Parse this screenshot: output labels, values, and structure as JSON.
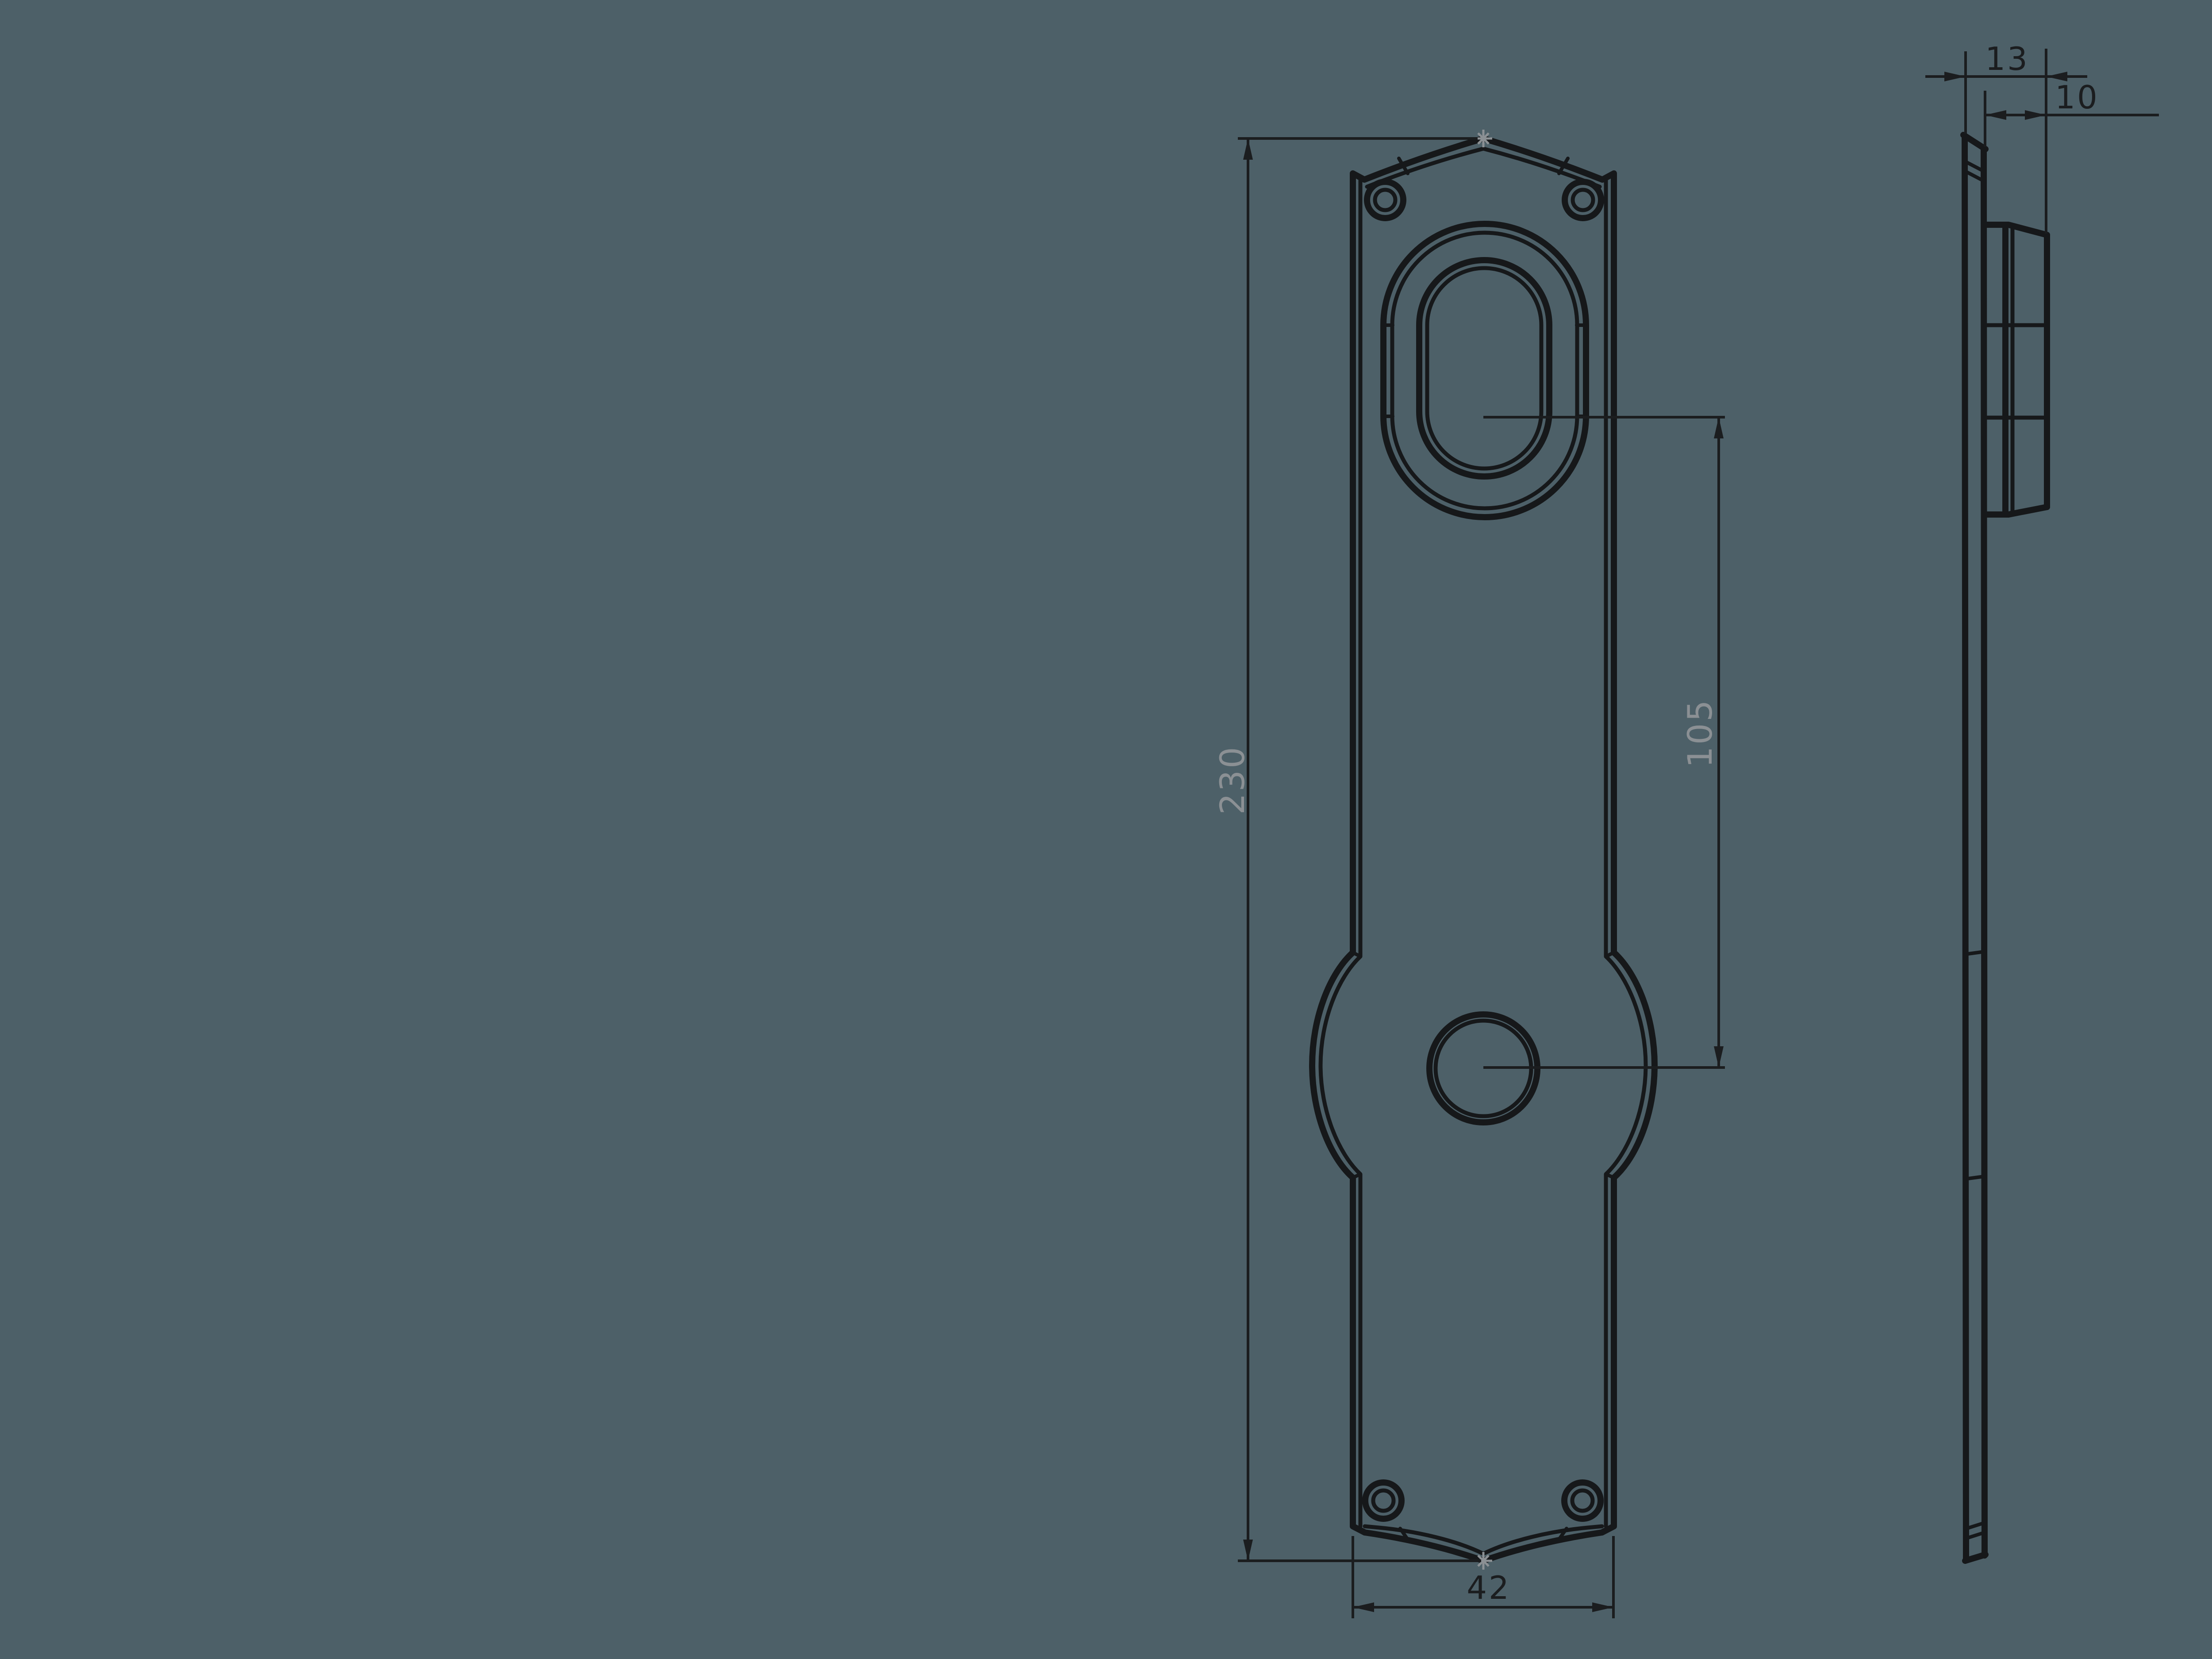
{
  "drawing": {
    "type": "technical-drawing",
    "part": "door-backplate",
    "views": {
      "front_view": {
        "features": [
          "arched-top",
          "oval-keyhole-boss",
          "spindle-hole",
          "four-screw-holes",
          "side-bulge",
          "curved-bottom"
        ]
      },
      "side_view": {
        "features": [
          "thin-plate-profile",
          "raised-boss-profile"
        ]
      }
    },
    "dimensions": {
      "overall_height": {
        "value": "230"
      },
      "hole_centers": {
        "value": "105"
      },
      "overall_width": {
        "value": "42"
      },
      "total_thickness": {
        "value": "13"
      },
      "boss_depth": {
        "value": "10"
      }
    },
    "colors": {
      "bg": "#4d6068",
      "line": "#16181a",
      "dim": "#1b1d1f",
      "graytext": "#8b9094"
    }
  }
}
